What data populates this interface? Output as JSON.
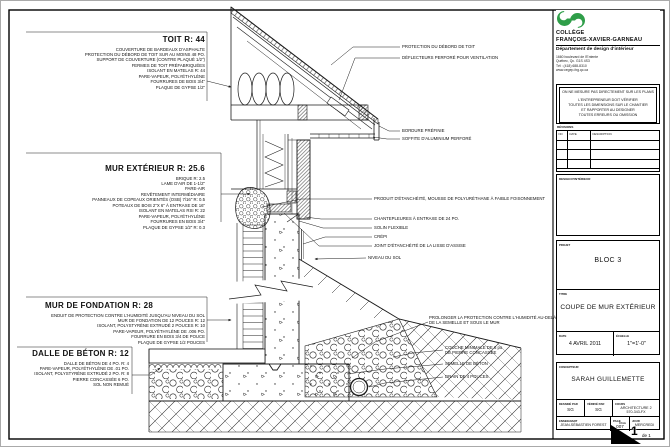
{
  "sheet": {
    "labels_left": [
      {
        "title": "TOIT R: 44",
        "x": 30,
        "y": 34,
        "w": 174,
        "title_align": "right",
        "lines": [
          "COUVERTURE DE BARDEAUX D'ASPHALTE",
          "PROTECTION DU DÉBORD DE TOIT SUR AU MOINS 48 PO.",
          "SUPPORT DE COUVERTURE (CONTRE PLAQUÉ 1/2\")",
          "FERMES DE TOIT PRÉFABRIQUÉES",
          "ISOLANT EN MATELAS R: 44",
          "PARE-VAPEUR, POLYÉTHYLÈNE",
          "FOURRURES DE BOIS 3/4\"",
          "PLAQUE DE GYPSE 1/2\""
        ]
      },
      {
        "title": "MUR EXTÉRIEUR R: 25.6",
        "x": 30,
        "y": 163,
        "w": 174,
        "title_align": "right",
        "lines": [
          "BRIQUE R: 2.5",
          "LAME D'AIR DE 1-1/2\"",
          "PARE-AIR",
          "REVÊTEMENT INTERMÉDIAIRE",
          "PANNEAUX DE COPEAUX ORIENTÉS (OSB) 7/16\" R: 0.5",
          "POTEAUX DE BOIS 2\"X 6\" À ENTRAXE DE 16\"",
          "ISOLANT EN MATELAS RSI R: 22",
          "PARE-VAPEUR, POLYÉTHYLÈNE",
          "FOURRURES EN BOIS 3/4\"",
          "PLAQUE DE GYPSE 1/2\" R: 0.3"
        ]
      },
      {
        "title": "MUR DE FONDATION R: 28",
        "x": 30,
        "y": 300,
        "w": 174,
        "title_align": "left",
        "lines": [
          "ENDUIT DE PROTECTION CONTRE L'HUMIDITÉ JUSQU'AU NIVEAU DU SOL",
          "MUR DE FONDATION DE 12 POUCES R: 12",
          "ISOLANT, POLYSTYRÈNE EXTRUDÉ 2 POUCES R: 10",
          "PARE-VAPEUR, POLYÉTHYLÈNE DE .006 PO.",
          "FOURRURE EN BOIS 3/4 DE POUCE",
          "PLAQUE DE GYPSE 1/2 POUCES"
        ]
      },
      {
        "title": "DALLE DE BÉTON R: 12",
        "x": 18,
        "y": 348,
        "w": 110,
        "title_align": "right",
        "lines": [
          "DALLE DE BÉTON DE 4 PO. R: 4",
          "PARE-VAPEUR, POLYÉTHYLÈNE DE .01 PO.",
          "ISOLANT, POLYSTYRÈNE EXTRUDÉ 2 PO. R: 8",
          "PIERRE CONCASSÉE 6 PO.",
          "SOL NON REMUÉ"
        ]
      }
    ],
    "callouts_right": [
      {
        "x": 401,
        "y": 43,
        "lines": [
          "PROTECTION DU DÉBORD DE TOIT"
        ]
      },
      {
        "x": 401,
        "y": 54,
        "lines": [
          "DÉFLECTEURS PERFORÉ POUR VENTILATION"
        ]
      },
      {
        "x": 401,
        "y": 127,
        "lines": [
          "BORDURE PRÉFINIE"
        ]
      },
      {
        "x": 401,
        "y": 135,
        "lines": [
          "SOFFITE D'ALUMINIUM PERFORÉ"
        ]
      },
      {
        "x": 373,
        "y": 195,
        "lines": [
          "PRODUIT D'ÉTANCHÉITÉ, MOUSSE DE POLYURÉTHANE À FAIBLE FOISONNEMENT"
        ]
      },
      {
        "x": 373,
        "y": 215,
        "lines": [
          "CHANTEPLEURES À ENTRAXE DE 24 PO."
        ]
      },
      {
        "x": 373,
        "y": 224,
        "lines": [
          "SOLIN FLEXIBLE"
        ]
      },
      {
        "x": 373,
        "y": 233,
        "lines": [
          "CRÉPI"
        ]
      },
      {
        "x": 373,
        "y": 242,
        "lines": [
          "JOINT D'ÉTANCHÉITÉ DE LA LISSE D'ASSISE"
        ]
      },
      {
        "x": 367,
        "y": 254,
        "lines": [
          "NIVEAU DU SOL"
        ]
      },
      {
        "x": 428,
        "y": 314,
        "lines": [
          "PROLONGER LA PROTECTION CONTRE L'HUMIDITÉ AU-DELÀ",
          "DE LA SEMELLE ET SOUS LE MUR"
        ]
      },
      {
        "x": 444,
        "y": 344,
        "lines": [
          "COUCHE MINIMALE DE 6 po",
          "DE PIERRE CONCASSÉE"
        ]
      },
      {
        "x": 444,
        "y": 360,
        "lines": [
          "SEMELLE DE BÉTON"
        ]
      },
      {
        "x": 444,
        "y": 373,
        "lines": [
          "DRAIN DE 4 POUCES"
        ]
      }
    ]
  },
  "titleblock": {
    "college": {
      "name_line1": "COLLÈGE",
      "name_line2": "FRANÇOIS-XAVIER-GARNEAU",
      "dept": "Département de design d'intérieur",
      "address1": "1660 boulevard de l'Entente",
      "address2": "Québec, Qc. G1S 4S3",
      "phone": "Tél : (418) 688-8310",
      "web": "www.cegep-fxg.qc.ca"
    },
    "notes": [
      "ON NE MESURE PAS DIRECTEMENT SUR LES PLANS",
      "L'ENTREPRENEUR DOIT VÉRIFIER",
      "TOUTES LES DIMENSIONS SUR LE CHANTIER",
      "ET RAPPORTER AU DESIGNER",
      "TOUTES ERREURS OU OMISSION"
    ],
    "revisions": {
      "label": "RÉVISIONS",
      "headers": [
        "NO",
        "DATE",
        "DESCRIPTION"
      ]
    },
    "seal_label": "DESIGN D'INTÉRIEUR",
    "project": {
      "label": "PROJET",
      "value": "BLOC 3"
    },
    "title": {
      "label": "TITRE",
      "value": "COUPE DE MUR EXTÉRIEUR"
    },
    "date": {
      "label": "DATE",
      "value": "4 AVRIL 2011"
    },
    "scale": {
      "label": "ÉCHELLE",
      "value": "1\"=1'-0\""
    },
    "designer": {
      "label": "CONCEPTEUR",
      "value": "SARAH GUILLEMETTE"
    },
    "drawn_by": {
      "label": "DESSINÉ PAR",
      "value": "SG"
    },
    "checked_by": {
      "label": "VÉRIFIÉ PAR",
      "value": "SG"
    },
    "course": {
      "label": "COURS",
      "value": "ARCHITECTURE 2",
      "value2": "570-343-FX"
    },
    "teacher": {
      "label": "ENSEIGNANT",
      "value": "JEAN-SÉBASTIEN FOREST"
    },
    "page_num": {
      "label": "PAGE",
      "value": "007"
    },
    "day": {
      "label": "JOUR",
      "value": "MERCREDI"
    },
    "sheet_page": {
      "label": "PAGE",
      "current": "1",
      "of": "de 1"
    }
  },
  "colors": {
    "logo_green": "#2f9e49",
    "line": "#1a1a1a"
  }
}
